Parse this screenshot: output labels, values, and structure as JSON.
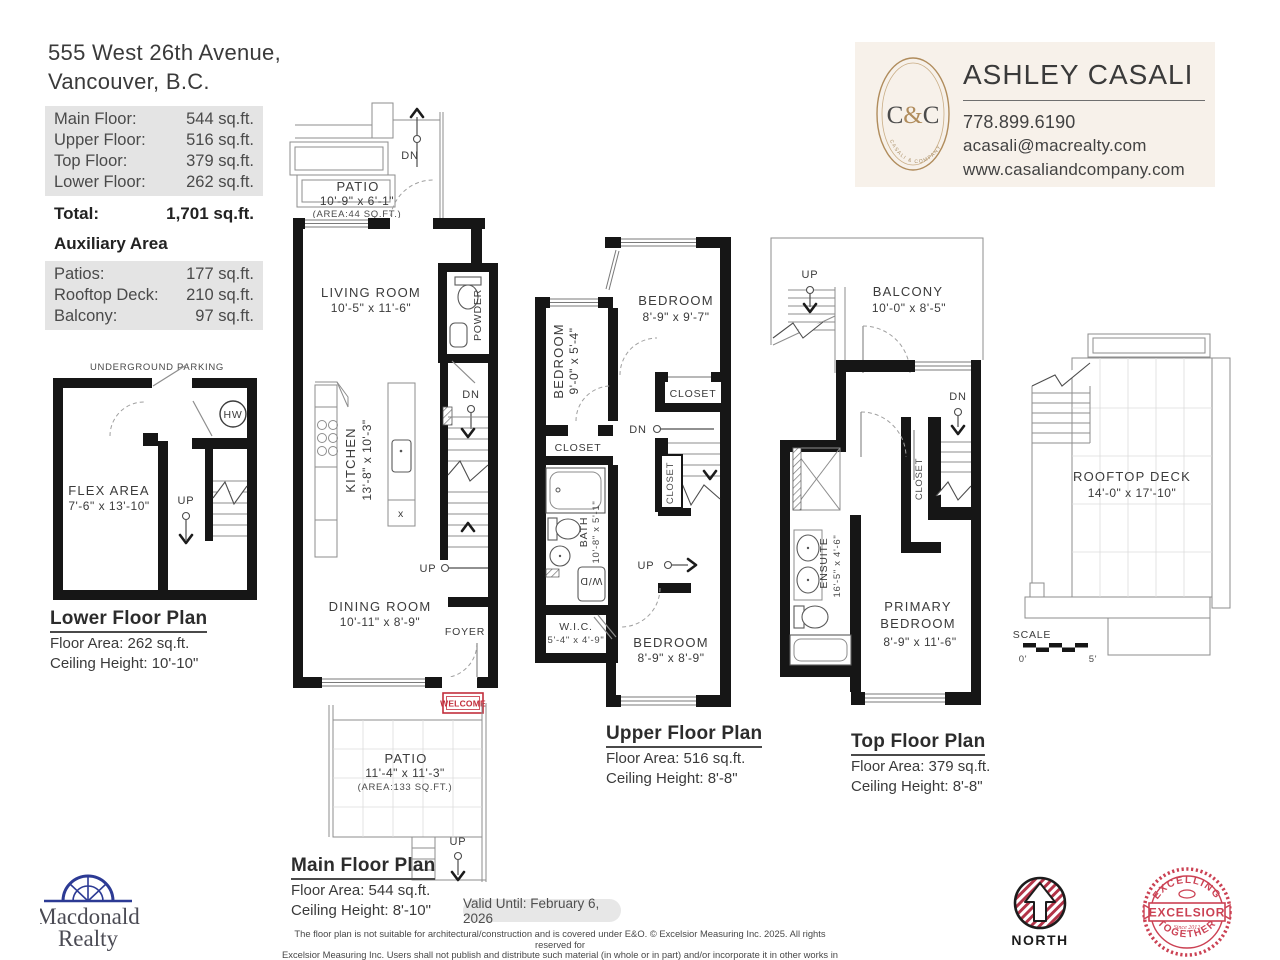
{
  "header": {
    "address_line1": "555 West 26th Avenue,",
    "address_line2": "Vancouver, B.C.",
    "floor_rows": [
      {
        "label": "Main Floor:",
        "value": "544 sq.ft."
      },
      {
        "label": "Upper Floor:",
        "value": "516 sq.ft."
      },
      {
        "label": "Top Floor:",
        "value": "379 sq.ft."
      },
      {
        "label": "Lower Floor:",
        "value": "262 sq.ft."
      }
    ],
    "total": {
      "label": "Total:",
      "value": "1,701 sq.ft."
    },
    "aux_title": "Auxiliary Area",
    "aux_rows": [
      {
        "label": "Patios:",
        "value": "177 sq.ft."
      },
      {
        "label": "Rooftop Deck:",
        "value": "210 sq.ft."
      },
      {
        "label": "Balcony:",
        "value": "97 sq.ft."
      }
    ]
  },
  "agent": {
    "name": "ASHLEY CASALI",
    "phone": "778.899.6190",
    "email": "acasali@macrealty.com",
    "website": "www.casaliandcompany.com",
    "logo_c1": "C",
    "logo_amp": "&",
    "logo_c2": "C",
    "logo_brand": "CASALI & COMPANY"
  },
  "lower": {
    "parking": "UNDERGROUND PARKING",
    "flex_name": "FLEX AREA",
    "flex_dims": "7'-6\"  x 13'-10\"",
    "hw": "HW",
    "up": "UP",
    "title": "Lower Floor Plan",
    "area": "Floor Area: 262 sq.ft.",
    "ceiling": "Ceiling Height: 10'-10\""
  },
  "main": {
    "dn": "DN",
    "up": "UP",
    "up2": "UP",
    "patio_top_name": "PATIO",
    "patio_top_dims": "10'-9\" x 6'-1\"",
    "patio_top_area": "(AREA:44 SQ.FT.)",
    "living_name": "LIVING ROOM",
    "living_dims": "10'-5\" x  11'-6\"",
    "powder": "POWDER",
    "kitchen_name": "KITCHEN",
    "kitchen_dims": "13'-8\" x 10'-3\"",
    "dining_name": "DINING ROOM",
    "dining_dims": "10'-11\" x  8'-9\"",
    "foyer": "FOYER",
    "welcome": "WELCOME",
    "dw_mark": "x",
    "patio_bot_name": "PATIO",
    "patio_bot_dims": "11'-4\"  x  11'-3\"",
    "patio_bot_area": "(AREA:133 SQ.FT.)",
    "title": "Main Floor Plan",
    "area": "Floor Area: 544 sq.ft.",
    "ceiling": "Ceiling Height: 8'-10\""
  },
  "upper": {
    "bed1_name": "BEDROOM",
    "bed1_dims": "8'-9\"  x  9'-7\"",
    "bed2_name": "BEDROOM",
    "bed2_dims": "9'-0\"  x  5'-4\"",
    "bed3_name": "BEDROOM",
    "bed3_dims": "8'-9\"  x  8'-9\"",
    "closet1": "CLOSET",
    "closet2": "CLOSET",
    "closet3": "CLOSET",
    "bath_name": "BATH",
    "bath_dims": "10'-8\" x  5'-1\"",
    "wd": "W/D",
    "wic_name": "W.I.C.",
    "wic_dims": "5'-4\" x  4'-9\"",
    "dn": "DN",
    "up": "UP",
    "title": "Upper Floor Plan",
    "area": "Floor Area: 516 sq.ft.",
    "ceiling": "Ceiling Height: 8'-8\""
  },
  "top": {
    "balcony_name": "BALCONY",
    "balcony_dims": "10'-0\" x  8'-5\"",
    "closet": "CLOSET",
    "ensuite_name": "ENSUITE",
    "ensuite_dims": "16'-5\" x 4'-6\"",
    "primary_line1": "PRIMARY",
    "primary_line2": "BEDROOM",
    "primary_dims": "8'-9\"  x  11'-6\"",
    "up": "UP",
    "dn": "DN",
    "title": "Top Floor Plan",
    "area": "Floor Area: 379 sq.ft.",
    "ceiling": "Ceiling Height: 8'-8\""
  },
  "roof": {
    "name": "ROOFTOP DECK",
    "dims": "14'-0\" x 17'-10\"",
    "scale_label": "SCALE",
    "scale_start": "0'",
    "scale_end": "5'"
  },
  "footer": {
    "brand_line1": "Macdonald",
    "brand_line2": "Realty",
    "valid": "Valid Until: February 6, 2026",
    "disclaimer1": "The floor plan is not suitable for architectural/construction and is covered under E&O. © Excelsior Measuring Inc. 2025. All rights reserved for",
    "disclaimer2": "Excelsior Measuring Inc. Users shall not publish and distribute such material (in whole or in part) and/or incorporate it in other works in any form.",
    "north": "NORTH",
    "seal_top": "· EXCELLING ·",
    "seal_mid": "EXCELSIOR",
    "seal_bottom": "· TOGETHER ·",
    "seal_since": "Since 2012"
  }
}
